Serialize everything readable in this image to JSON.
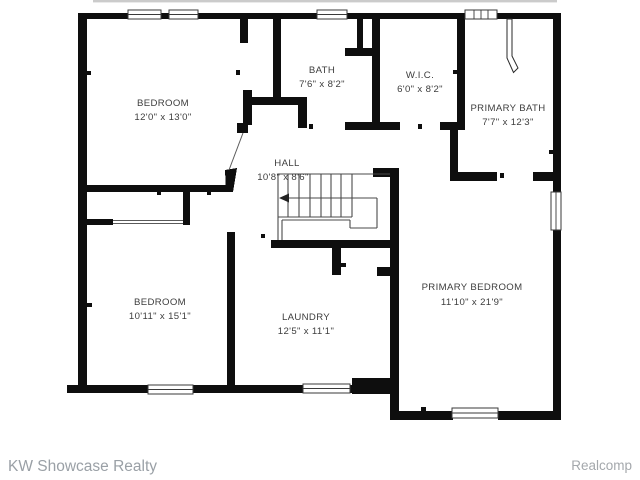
{
  "plan_title": "Second floor residential floor plan",
  "rooms": [
    {
      "name": "BEDROOM",
      "dims": "12'0\" x 13'0\""
    },
    {
      "name": "BATH",
      "dims": "7'6\" x 8'2\""
    },
    {
      "name": "W.I.C.",
      "dims": "6'0\" x 8'2\""
    },
    {
      "name": "PRIMARY BATH",
      "dims": "7'7\" x 12'3\""
    },
    {
      "name": "HALL",
      "dims": "10'8\" x 8'6\""
    },
    {
      "name": "BEDROOM",
      "dims": "10'11\" x 15'1\""
    },
    {
      "name": "LAUNDRY",
      "dims": "12'5\" x 11'1\""
    },
    {
      "name": "PRIMARY BEDROOM",
      "dims": "11'10\" x 21'9\""
    }
  ],
  "footer": {
    "left": "KW Showcase Realty",
    "right": "Realcomp"
  },
  "colors": {
    "wall": "#0e0e0e",
    "thin_line": "#4a4a4a",
    "label_text": "#3d3d3d",
    "footer_text": "#9aa0a6",
    "roofline": "#cbcbcb",
    "background": "#ffffff"
  }
}
